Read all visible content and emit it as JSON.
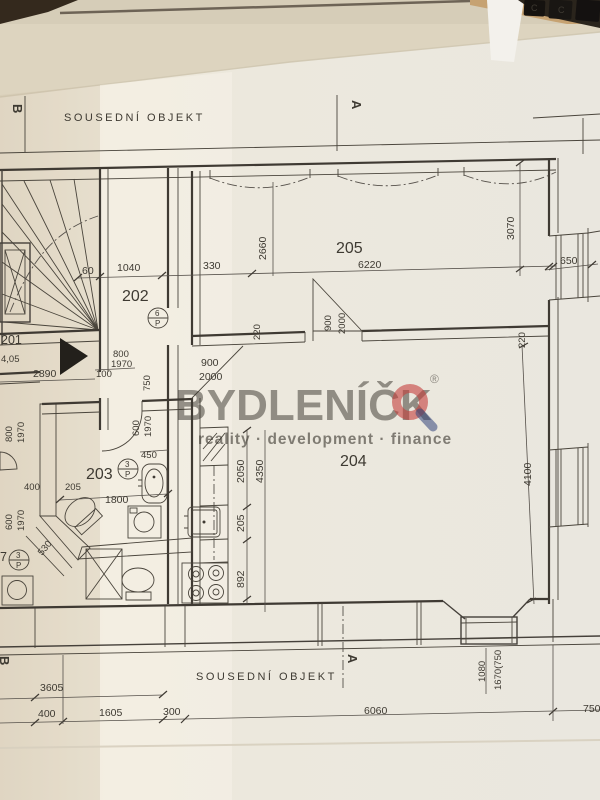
{
  "photo": {
    "keyboard_keys": [
      "C",
      "C"
    ]
  },
  "watermark": {
    "brand": "BYDLENÍČK",
    "registered": "®",
    "tagline": "reality · development · finance",
    "brand_color": "#2e4078",
    "accent_color": "#c4403c"
  },
  "boundaries": {
    "top": "SOUSEDNÍ OBJEKT",
    "bottom": "SOUSEDNÍ OBJEKT"
  },
  "sections": {
    "a": "A",
    "b": "B"
  },
  "rooms": {
    "r201": {
      "number": "201",
      "area": "4,05"
    },
    "r202": {
      "number": "202"
    },
    "r203": {
      "number": "203"
    },
    "r204": {
      "number": "204"
    },
    "r205": {
      "number": "205"
    },
    "r207": {
      "number": "7"
    }
  },
  "door_tags": {
    "t202": {
      "top": "6",
      "bottom": "P"
    },
    "t203": {
      "top": "3",
      "bottom": "P"
    },
    "t207": {
      "top": "3",
      "bottom": "P"
    }
  },
  "dims": {
    "d60": "60",
    "d1040": "1040",
    "d330": "330",
    "d6220": "6220",
    "d2660": "2660",
    "d3070": "3070",
    "d650": "650",
    "d220a": "220",
    "d220b": "220",
    "d900a": "900",
    "d2000a": "2000",
    "d900b": "900",
    "d2000b": "2000",
    "d800a": "800",
    "d1970a": "1970",
    "d100": "100",
    "d2890": "2890",
    "d750a": "750",
    "d600a": "600",
    "d1970b": "1970",
    "d450": "450",
    "d800b": "800",
    "d1970c": "1970",
    "d400a": "400",
    "d600b": "600",
    "d1970d": "1970",
    "d530": "530",
    "d205a": "205",
    "d1800": "1800",
    "d2050": "2050",
    "d4350": "4350",
    "d205b": "205",
    "d892": "892",
    "d4100": "4100",
    "d1080": "1080",
    "d1670": "1670(750",
    "d3605": "3605",
    "d400b": "400",
    "d1605": "1605",
    "d300": "300",
    "d6060": "6060",
    "d750b": "750"
  }
}
